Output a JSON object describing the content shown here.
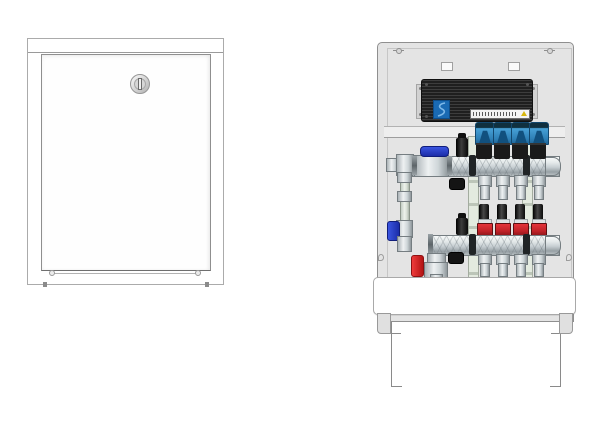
{
  "figure": {
    "type": "product-technical-illustration",
    "subject": "underfloor-heating manifold cabinet shown closed (left) and open (right)",
    "views": [
      {
        "id": "closed-view",
        "description": "front view with door closed"
      },
      {
        "id": "open-view",
        "description": "front view without door, 4-circuit manifold visible"
      }
    ]
  },
  "closed_view": {
    "door": {
      "lock_type": "round rotary lock with vertical slot",
      "hinge_count": 2,
      "bottom_screw_count": 2
    }
  },
  "open_view": {
    "top_screw_count": 2,
    "knockout_slot_count": 2,
    "wiring_box": {
      "style": "black ribbed electrical connection box",
      "logo": "blue-square-logo",
      "label": {
        "text": "",
        "legible": false,
        "warning_triangle": true
      }
    },
    "circuit_count": 4,
    "upper_manifold": {
      "type": "flow manifold",
      "actuator_count": 4,
      "parts": [
        "blue-ball-valve",
        "black-air-vent",
        "black-drain-knob",
        "chrome-end-cap",
        "4 loop outlets"
      ]
    },
    "lower_manifold": {
      "type": "return manifold",
      "flow_meter_count": 4,
      "parts": [
        "red-fill-drain-valve",
        "black-air-vent",
        "black-drain-knob",
        "chrome-end-cap",
        "4 loop outlets"
      ]
    },
    "left_riser": {
      "parts": [
        "pipe",
        "blue-mini-valve",
        "union-fittings"
      ]
    },
    "base": {
      "front_cover_bar": "white",
      "adjustable_legs_outline": 2
    }
  },
  "colors": {
    "background": "#ffffff",
    "cabinet_fill": "#e4e4e4",
    "line": "#8f8f8f",
    "box_black": "#262626",
    "logo_blue": "#1a6ab3",
    "warning_yellow": "#d8b70e",
    "actuator_blue": "#3a90c8",
    "actuator_dark_blue": "#11507e",
    "flow_meter_red": "#c02228",
    "valve_handle_blue": "#2a3fd6",
    "valve_handle_red": "#e32426",
    "chrome_light": "#eef1f2",
    "chrome_dark": "#8f979b",
    "bracket_green": "#e3eadf"
  }
}
